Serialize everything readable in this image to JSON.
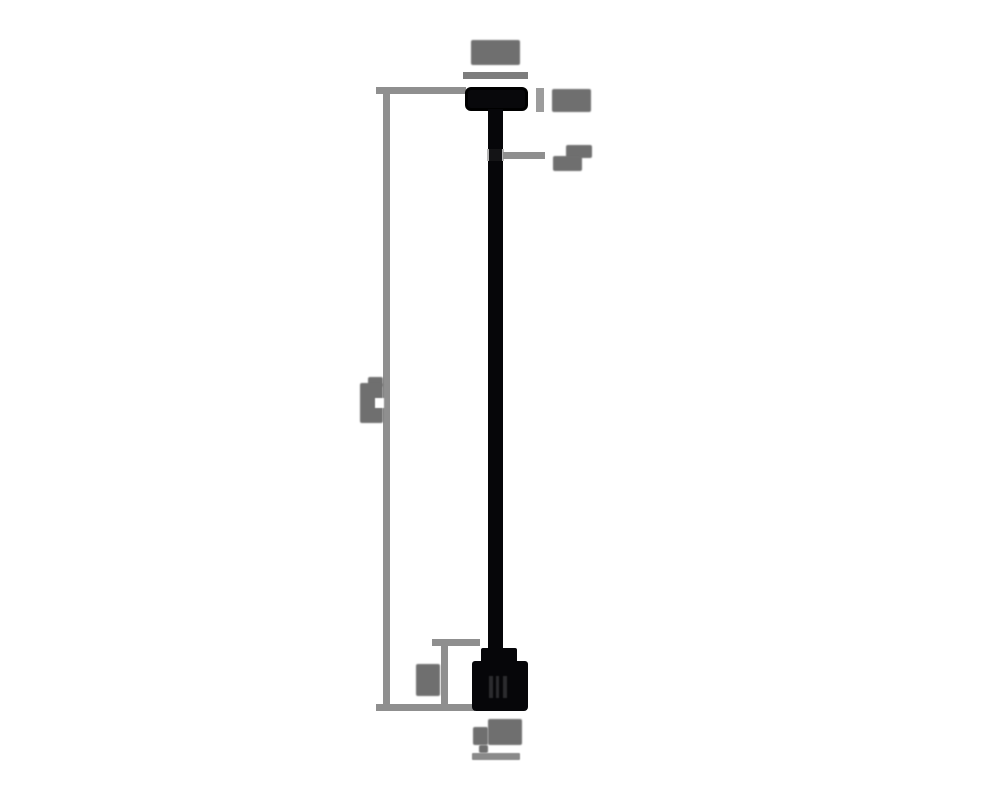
{
  "page": {
    "background": "#ffffff"
  },
  "diagram": {
    "type": "technical-dimension-drawing",
    "subject": "pendant light fixture, side elevation with dimension callouts",
    "colors": {
      "page_bg": "#ffffff",
      "line_gray": "#8f8f8f",
      "dim_gray": "#7d7d7d",
      "tick_gray": "#9c9c9c",
      "label_gray": "#6f6f6f",
      "label_bar_gray": "#8a8a8a",
      "part_black": "#060609"
    },
    "parts": [
      {
        "name": "canopy",
        "description": "ceiling canopy (black rounded block at top)"
      },
      {
        "name": "stem",
        "description": "long vertical stem rod"
      },
      {
        "name": "coupler",
        "description": "small coupler fitting on stem"
      },
      {
        "name": "socket",
        "description": "socket / bulb housing at bottom"
      }
    ],
    "annotations": [
      {
        "id": "canopy-width",
        "text": "",
        "legible": false,
        "placement": "above canopy"
      },
      {
        "id": "canopy-height",
        "text": "",
        "legible": false,
        "placement": "right of canopy"
      },
      {
        "id": "stem-diameter",
        "text": "",
        "legible": false,
        "placement": "right of stem coupler, with leader line"
      },
      {
        "id": "overall-height",
        "text": "",
        "legible": false,
        "placement": "left side, rotated label on tall bracket"
      },
      {
        "id": "socket-height",
        "text": "",
        "legible": false,
        "placement": "left of socket, small bracket"
      },
      {
        "id": "socket-diameter",
        "text": "",
        "legible": false,
        "placement": "below socket"
      }
    ]
  }
}
